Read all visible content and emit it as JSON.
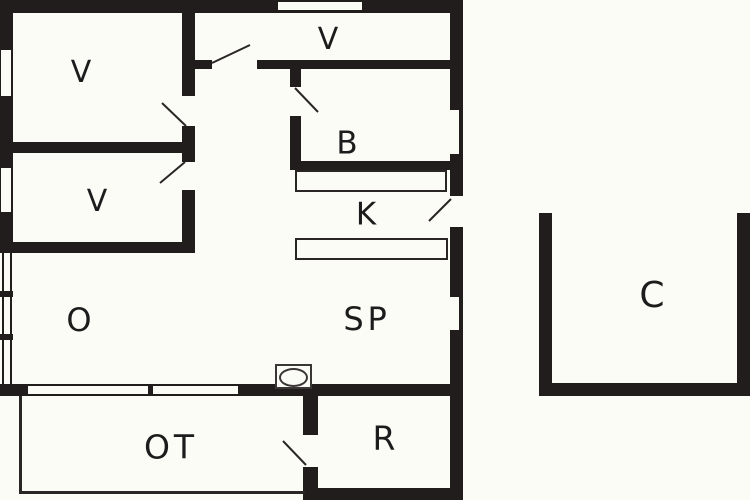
{
  "diagram": {
    "type": "floor plan",
    "wall_color": "#211d1d",
    "background_color": "#fcfcf7",
    "line_color": "#2a2626",
    "text_color": "#1c1c1c"
  },
  "rooms": {
    "v_top_left": {
      "label": "V"
    },
    "v_bottom_left": {
      "label": "V"
    },
    "v_top_middle": {
      "label": "V"
    },
    "bathroom": {
      "label": "B"
    },
    "kitchen": {
      "label": "K"
    },
    "living": {
      "label": "O"
    },
    "living_dining": {
      "label": "SP"
    },
    "terrace": {
      "label": "OT"
    },
    "utility": {
      "label": "R"
    },
    "carport": {
      "label": "C"
    }
  }
}
